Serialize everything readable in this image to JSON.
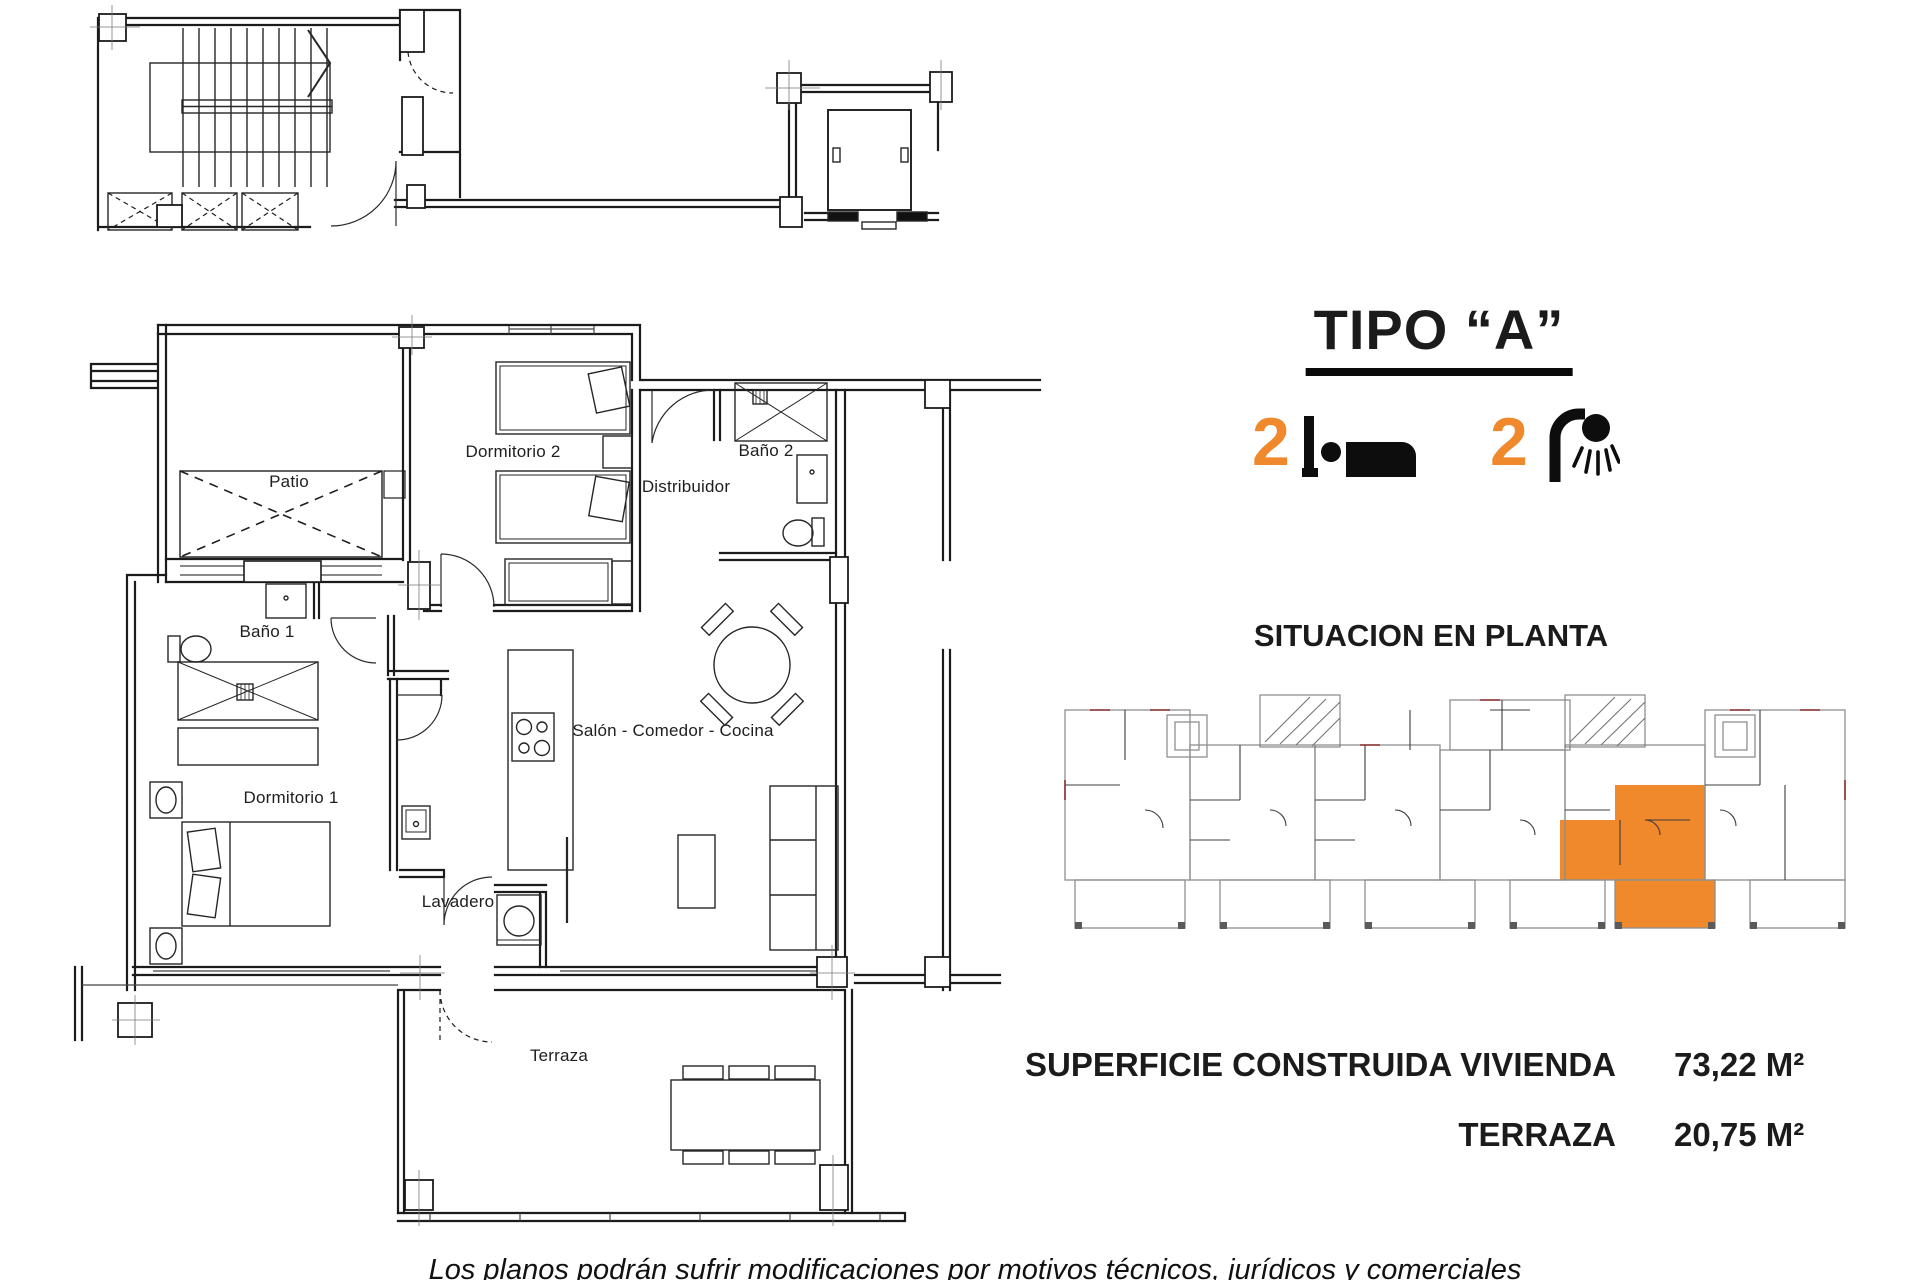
{
  "header": {
    "title": "TIPO “A”"
  },
  "features": {
    "bedrooms": {
      "count": "2",
      "icon": "bed-icon"
    },
    "bathrooms": {
      "count": "2",
      "icon": "shower-icon"
    }
  },
  "situacion": {
    "title": "SITUACION EN PLANTA"
  },
  "areas": {
    "rows": [
      {
        "label": "SUPERFICIE CONSTRUIDA VIVIENDA",
        "value": "73,22 M²"
      },
      {
        "label": "TERRAZA",
        "value": "20,75 M²"
      }
    ]
  },
  "floorplan": {
    "rooms": [
      {
        "id": "patio",
        "label": "Patio"
      },
      {
        "id": "dormitorio2",
        "label": "Dormitorio 2"
      },
      {
        "id": "bano2",
        "label": "Baño 2"
      },
      {
        "id": "distribuidor",
        "label": "Distribuidor"
      },
      {
        "id": "bano1",
        "label": "Baño 1"
      },
      {
        "id": "salon",
        "label": "Salón - Comedor - Cocina"
      },
      {
        "id": "dormitorio1",
        "label": "Dormitorio 1"
      },
      {
        "id": "lavadero",
        "label": "Lavadero"
      },
      {
        "id": "terraza",
        "label": "Terraza"
      }
    ]
  },
  "footer": {
    "disclaimer": "Los planos podrán sufrir modificaciones por motivos técnicos, jurídicos y comerciales"
  },
  "colors": {
    "accent_orange": "#F0882C",
    "line": "#1b1b1b",
    "mini_gray": "#8f8f8f"
  }
}
